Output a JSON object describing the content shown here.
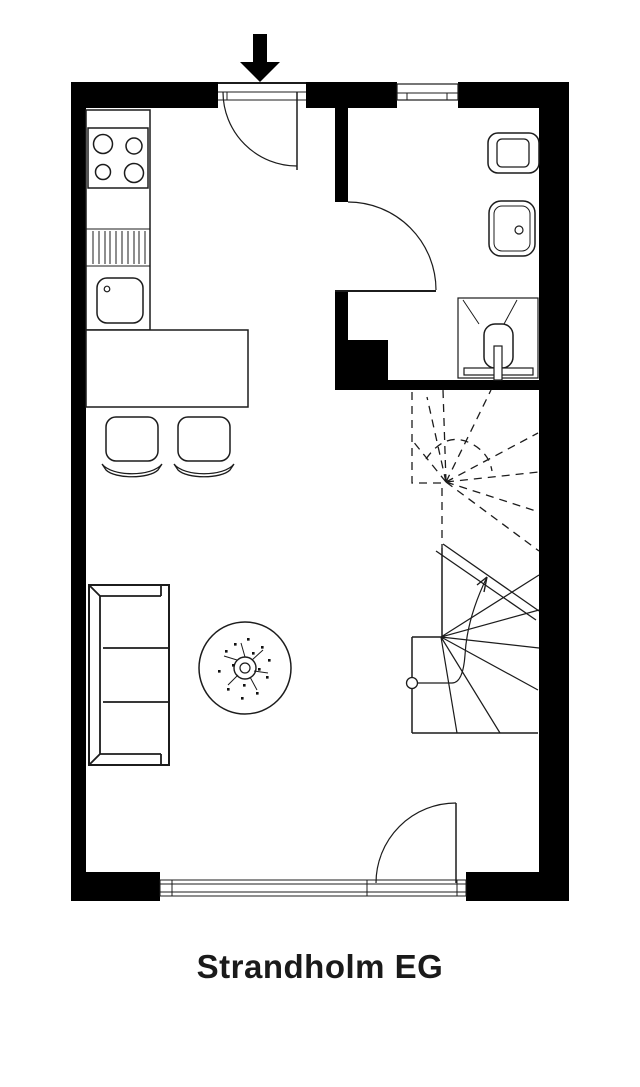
{
  "title": "Strandholm EG",
  "plan": {
    "label": "Strandholm EG",
    "colors": {
      "walls": "#000000",
      "background": "#ffffff",
      "lines": "#1c1c1c"
    },
    "entrance": {
      "arrow_direction": "down"
    },
    "symbols": [
      "entrance-arrow",
      "entrance-door",
      "stove-4-burners",
      "counter-drainer",
      "kitchen-sink",
      "dining-table",
      "chair",
      "chair",
      "sofa-3-seat",
      "plant-on-round-table",
      "toilet",
      "washbasin",
      "corner-shower",
      "winder-staircase",
      "terrace-door",
      "bathroom-window",
      "living-room-window",
      "bathroom-door"
    ]
  }
}
